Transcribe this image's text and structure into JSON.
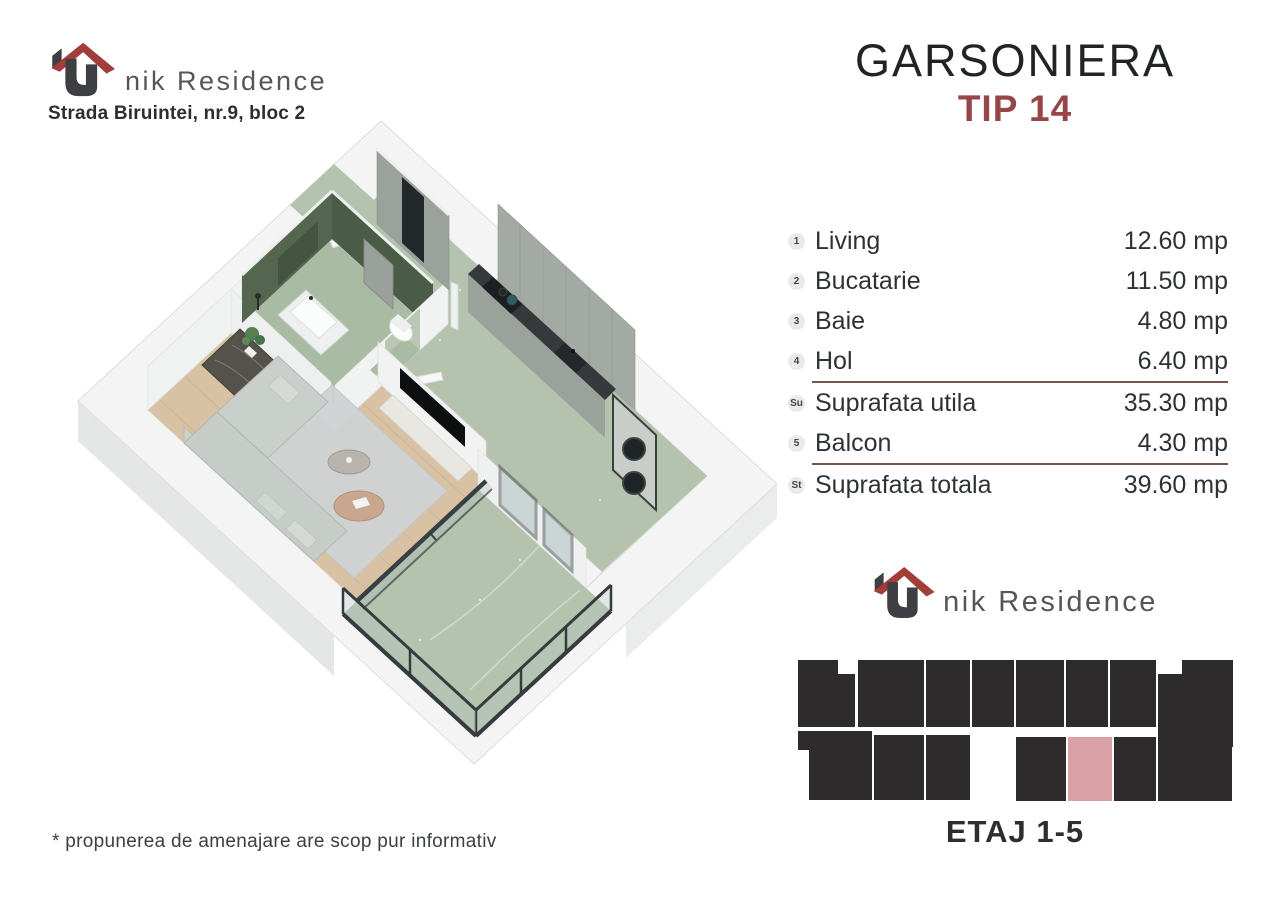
{
  "header": {
    "brand_text": "nik Residence",
    "brand_full": "Unik Residence",
    "address": "Strada Biruintei, nr.9, bloc 2"
  },
  "title": {
    "main": "GARSONIERA",
    "subtitle": "TIP 14"
  },
  "areas": {
    "unit": "mp",
    "rows": [
      {
        "badge": "1",
        "label": "Living",
        "value": "12.60 mp"
      },
      {
        "badge": "2",
        "label": "Bucatarie",
        "value": "11.50 mp"
      },
      {
        "badge": "3",
        "label": "Baie",
        "value": "4.80 mp"
      },
      {
        "badge": "4",
        "label": "Hol",
        "value": "6.40 mp"
      },
      {
        "badge": "Su",
        "label": "Suprafata utila",
        "value": "35.30 mp"
      },
      {
        "badge": "5",
        "label": "Balcon",
        "value": "4.30 mp"
      },
      {
        "badge": "St",
        "label": "Suprafata totala",
        "value": "39.60 mp"
      }
    ]
  },
  "footer_brand": {
    "brand_text": "nik Residence"
  },
  "floor_diagram": {
    "label": "ETAJ 1-5",
    "highlighted_unit": "TIP 14"
  },
  "disclaimer": "* propunerea de amenajare are scop pur informativ",
  "palette": {
    "accent_red": "#964548",
    "logo_roof_red": "#a33d39",
    "logo_body_dark": "#3e3f42",
    "gray_text": "#58595c",
    "dark_text": "#232629",
    "divider_brown": "#7d564e",
    "diagram_block": "#2e2b2c",
    "diagram_highlight": "#d9a0a6",
    "terrazzo_green": "#b5c3ae",
    "bathroom_wall_green": "#50614b",
    "wood_floor": "#d8c2a3",
    "wall_white": "#f3f4f3"
  }
}
